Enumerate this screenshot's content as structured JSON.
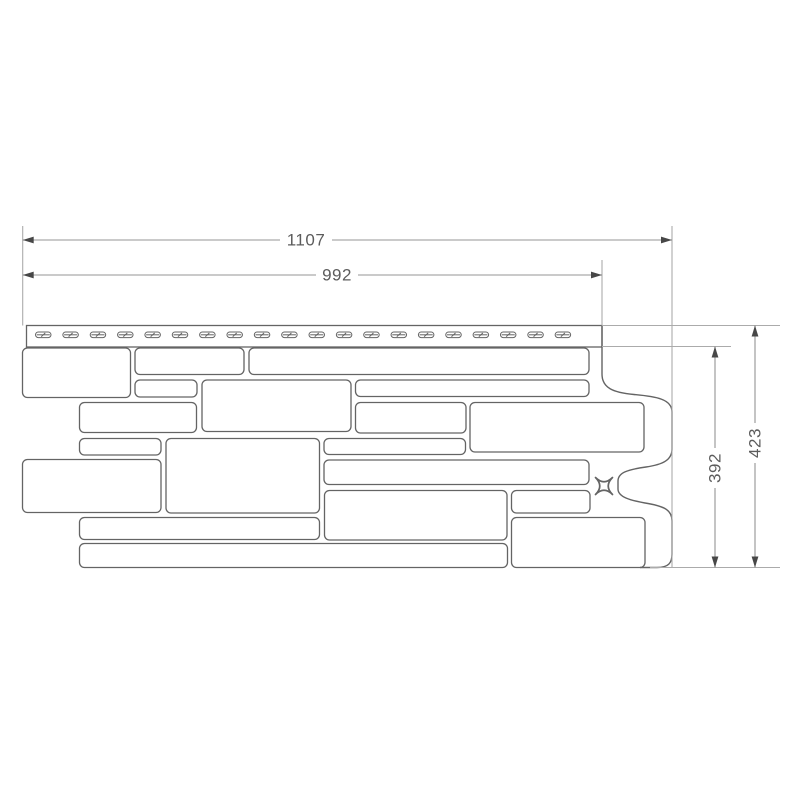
{
  "drawing": {
    "type": "technical-dimension-drawing",
    "subject": "facade-panel-front-view",
    "canvas": {
      "width": 800,
      "height": 800
    },
    "colors": {
      "background": "#ffffff",
      "panel_outline": "#646464",
      "dimension_line": "#949494",
      "extension_line": "#ababab",
      "arrow": "#474747",
      "label_text": "#5c5c5c"
    },
    "dimensions": {
      "width_total": "1107",
      "width_exposed": "992",
      "height_total": "423",
      "height_exposed": "392"
    },
    "geometry": {
      "nail_strip": {
        "x": 26.5,
        "y": 325.5,
        "w": 575.5,
        "h": 21.5
      },
      "slots": {
        "count": 20,
        "start_x": 35.5,
        "pitch": 27.35,
        "y": 332,
        "w": 15.5,
        "h": 5.6
      },
      "stones": [
        [
          22.5,
          348,
          108,
          49.5
        ],
        [
          135,
          348,
          109,
          26.5
        ],
        [
          249,
          348,
          340,
          26.5
        ],
        [
          135,
          380,
          62,
          17
        ],
        [
          202,
          380,
          149,
          51.5
        ],
        [
          355.5,
          380,
          233.5,
          16.5
        ],
        [
          79.5,
          402.5,
          117,
          30
        ],
        [
          355.5,
          402.5,
          110.5,
          30.5
        ],
        [
          470,
          402.5,
          174,
          49.5
        ],
        [
          79.5,
          438.5,
          81.5,
          16.5
        ],
        [
          166,
          438.5,
          153.5,
          74.5
        ],
        [
          324,
          438.5,
          141.5,
          16
        ],
        [
          22.5,
          459.5,
          138.5,
          53
        ],
        [
          324,
          460,
          265,
          24.5
        ],
        [
          324.5,
          490.5,
          182.5,
          49.5
        ],
        [
          511.5,
          490.5,
          78.5,
          22.5
        ],
        [
          79.5,
          517.5,
          240,
          22
        ],
        [
          511.5,
          517.5,
          133.5,
          50
        ],
        [
          79.5,
          543.5,
          428,
          24
        ]
      ],
      "stone_corner_radius": 5,
      "right_profile_path": "M 602 325.5 L 602 374 C 602 388 613 392.5 634 394.5 C 656 396.5 672 399 672 412 L 672 449 C 672 460 663 464.5 646 467 C 628 469.5 618 472.5 618 481 L 618 489 C 618 497 630 500.5 648 503.5 C 665 506.5 672 510.5 672 521 L 672 554 C 672 563 668.5 567.5 657 567.5 L 640 567.5",
      "x_mark": {
        "cx": 604,
        "cy": 486,
        "r": 8.5
      },
      "extension_lines": [
        [
          22.7,
          226,
          22.7,
          325.5
        ],
        [
          602,
          260,
          602,
          325.5
        ],
        [
          672,
          226,
          672,
          567.5
        ],
        [
          602,
          325.5,
          780,
          325.5
        ],
        [
          602,
          346.5,
          731,
          346.5
        ],
        [
          650,
          567.5,
          780,
          567.5
        ]
      ],
      "h_dims": [
        {
          "key": "width_total",
          "name": "width-total",
          "y": 240,
          "x1": 22.7,
          "x2": 672,
          "tx": 306,
          "half_gap": 26
        },
        {
          "key": "width_exposed",
          "name": "width-exposed",
          "y": 275,
          "x1": 22.7,
          "x2": 602,
          "tx": 337,
          "half_gap": 21
        }
      ],
      "v_dims": [
        {
          "key": "height_exposed",
          "name": "height-exposed",
          "x": 715,
          "y1": 346.5,
          "y2": 567.5,
          "ty": 468,
          "half_gap": 20
        },
        {
          "key": "height_total",
          "name": "height-total",
          "x": 755,
          "y1": 325.5,
          "y2": 567.5,
          "ty": 443,
          "half_gap": 20
        }
      ],
      "label_font_size": 17
    }
  }
}
